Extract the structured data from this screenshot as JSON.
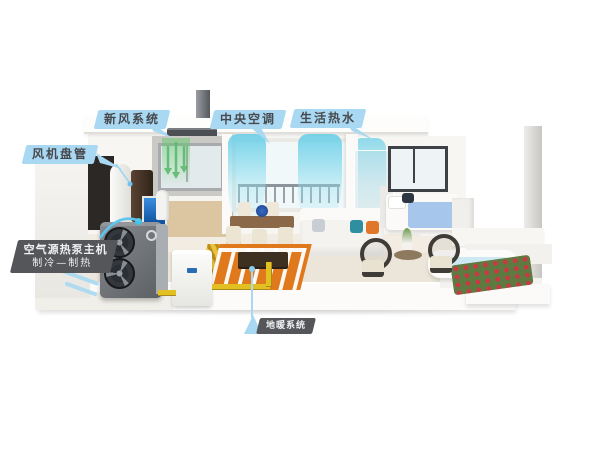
{
  "labels": {
    "fresh_air": {
      "text": "新风系统"
    },
    "central_ac": {
      "text": "中央空调"
    },
    "hot_water": {
      "text": "生活热水"
    },
    "fan_coil": {
      "text": "风机盘管"
    },
    "heat_pump": {
      "line1": "空气源热泵主机",
      "line2": "制冷—制热"
    },
    "floor_heating": {
      "text": "地暖系统"
    }
  },
  "colors": {
    "callout_blue": "#a9d8f3",
    "callout_dark": "#54565a",
    "callout_text_dark": "#47494c",
    "callout_text_light": "#eef0f2",
    "leader_blue": "#9ad4f2",
    "air_curtain_teal": "#62ccE6",
    "fresh_air_green": "#57b868",
    "floor_heating_orange": "#e0781c",
    "pipe_yellow": "#e3c022"
  },
  "scene": {
    "elements": [
      "heat-pump-outdoor-unit",
      "buffer-tank",
      "hot-water-tank",
      "floor-standing-fan-coil",
      "aquarium",
      "ceiling-fresh-air-unit",
      "roof-duct",
      "kitchen-cabinets",
      "dining-window",
      "air-curtain-flows",
      "dining-table-set",
      "living-room-sofa",
      "coffee-table",
      "floor-heating-coils",
      "bedroom-bed",
      "bedroom-window",
      "terrace-bathtub",
      "flower-planter",
      "rattan-chairs",
      "yellow-pipes",
      "air-intake-wind"
    ]
  }
}
